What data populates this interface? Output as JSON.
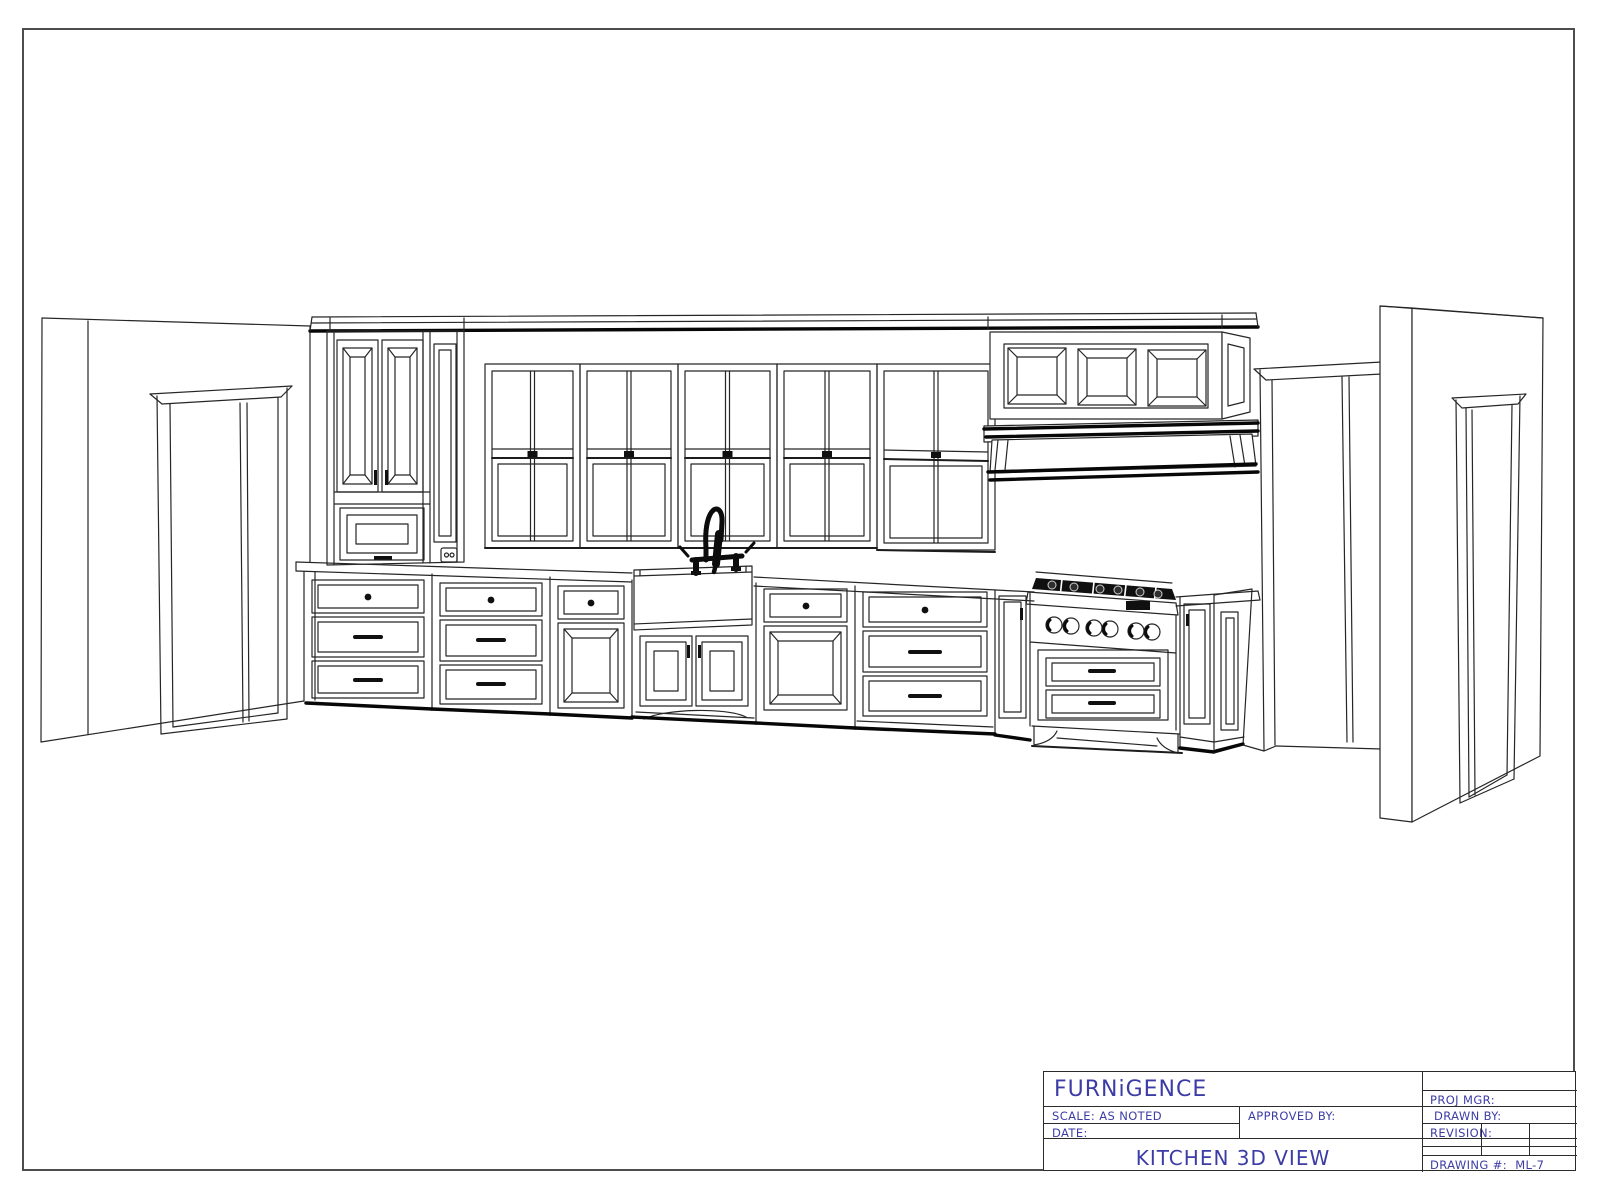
{
  "title_block": {
    "company": "FURNiGENCE",
    "scale": "SCALE: AS NOTED",
    "approved_by": "APPROVED BY:",
    "date": "DATE:",
    "view_title": "KITCHEN 3D VIEW",
    "proj_mgr": "PROJ MGR:",
    "drawn_by": "DRAWN BY:",
    "revision": "REVISION:",
    "drawing_label": "DRAWING #:",
    "drawing_number": "ML-7"
  },
  "drawing": {
    "description": "Perspective line drawing of a single-wall kitchen: tall pantry cabinet, five double-hung windows, paneled range hood, farmhouse sink with black bridge faucet, six-burner range, base cabinets with drawers, door openings at both ends",
    "colors": {
      "line": "#262626",
      "accent_text": "#3c3ca6",
      "background": "#ffffff"
    }
  }
}
